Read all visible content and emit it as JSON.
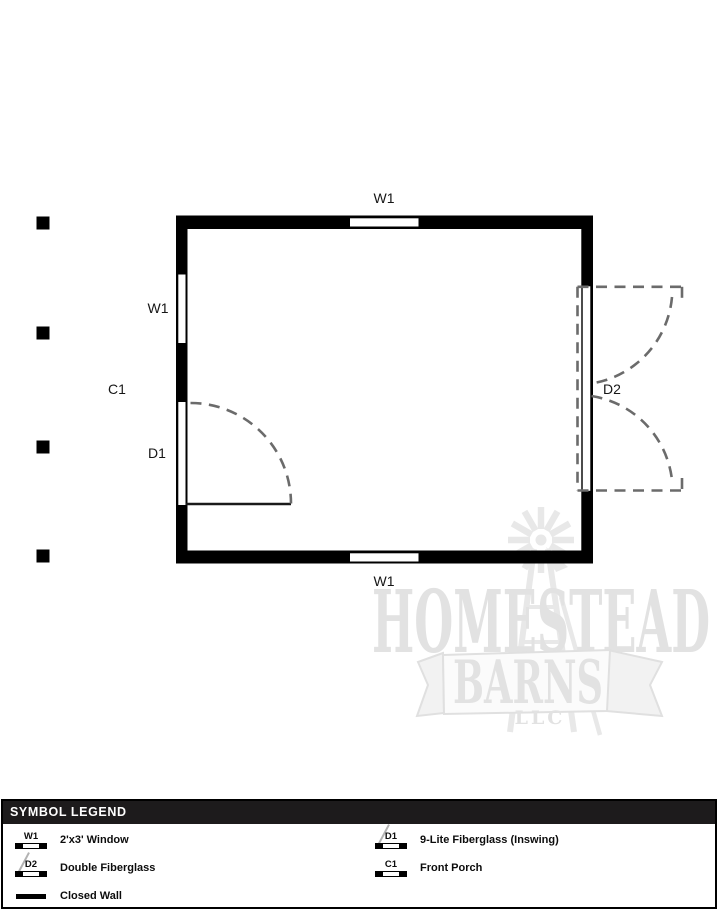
{
  "plan": {
    "labels": {
      "window_top": "W1",
      "window_left": "W1",
      "porch": "C1",
      "door_left": "D1",
      "door_right": "D2",
      "window_bottom": "W1"
    }
  },
  "watermark": {
    "name_top": "HOMESTEAD",
    "name_mid": "BARNS",
    "name_bottom": "LLC"
  },
  "legend": {
    "title": "SYMBOL LEGEND",
    "items": [
      {
        "code": "W1",
        "label": "2'x3' Window"
      },
      {
        "code": "D2",
        "label": "Double Fiberglass"
      },
      {
        "code": "",
        "label": "Closed Wall"
      },
      {
        "code": "D1",
        "label": "9-Lite Fiberglass (Inswing)"
      },
      {
        "code": "C1",
        "label": "Front Porch"
      }
    ]
  },
  "colors": {
    "wall": "#000000",
    "swing_dash": "#6b6b6b",
    "watermark": "#e8e8e8",
    "legend_bar": "#1d1b1c"
  }
}
